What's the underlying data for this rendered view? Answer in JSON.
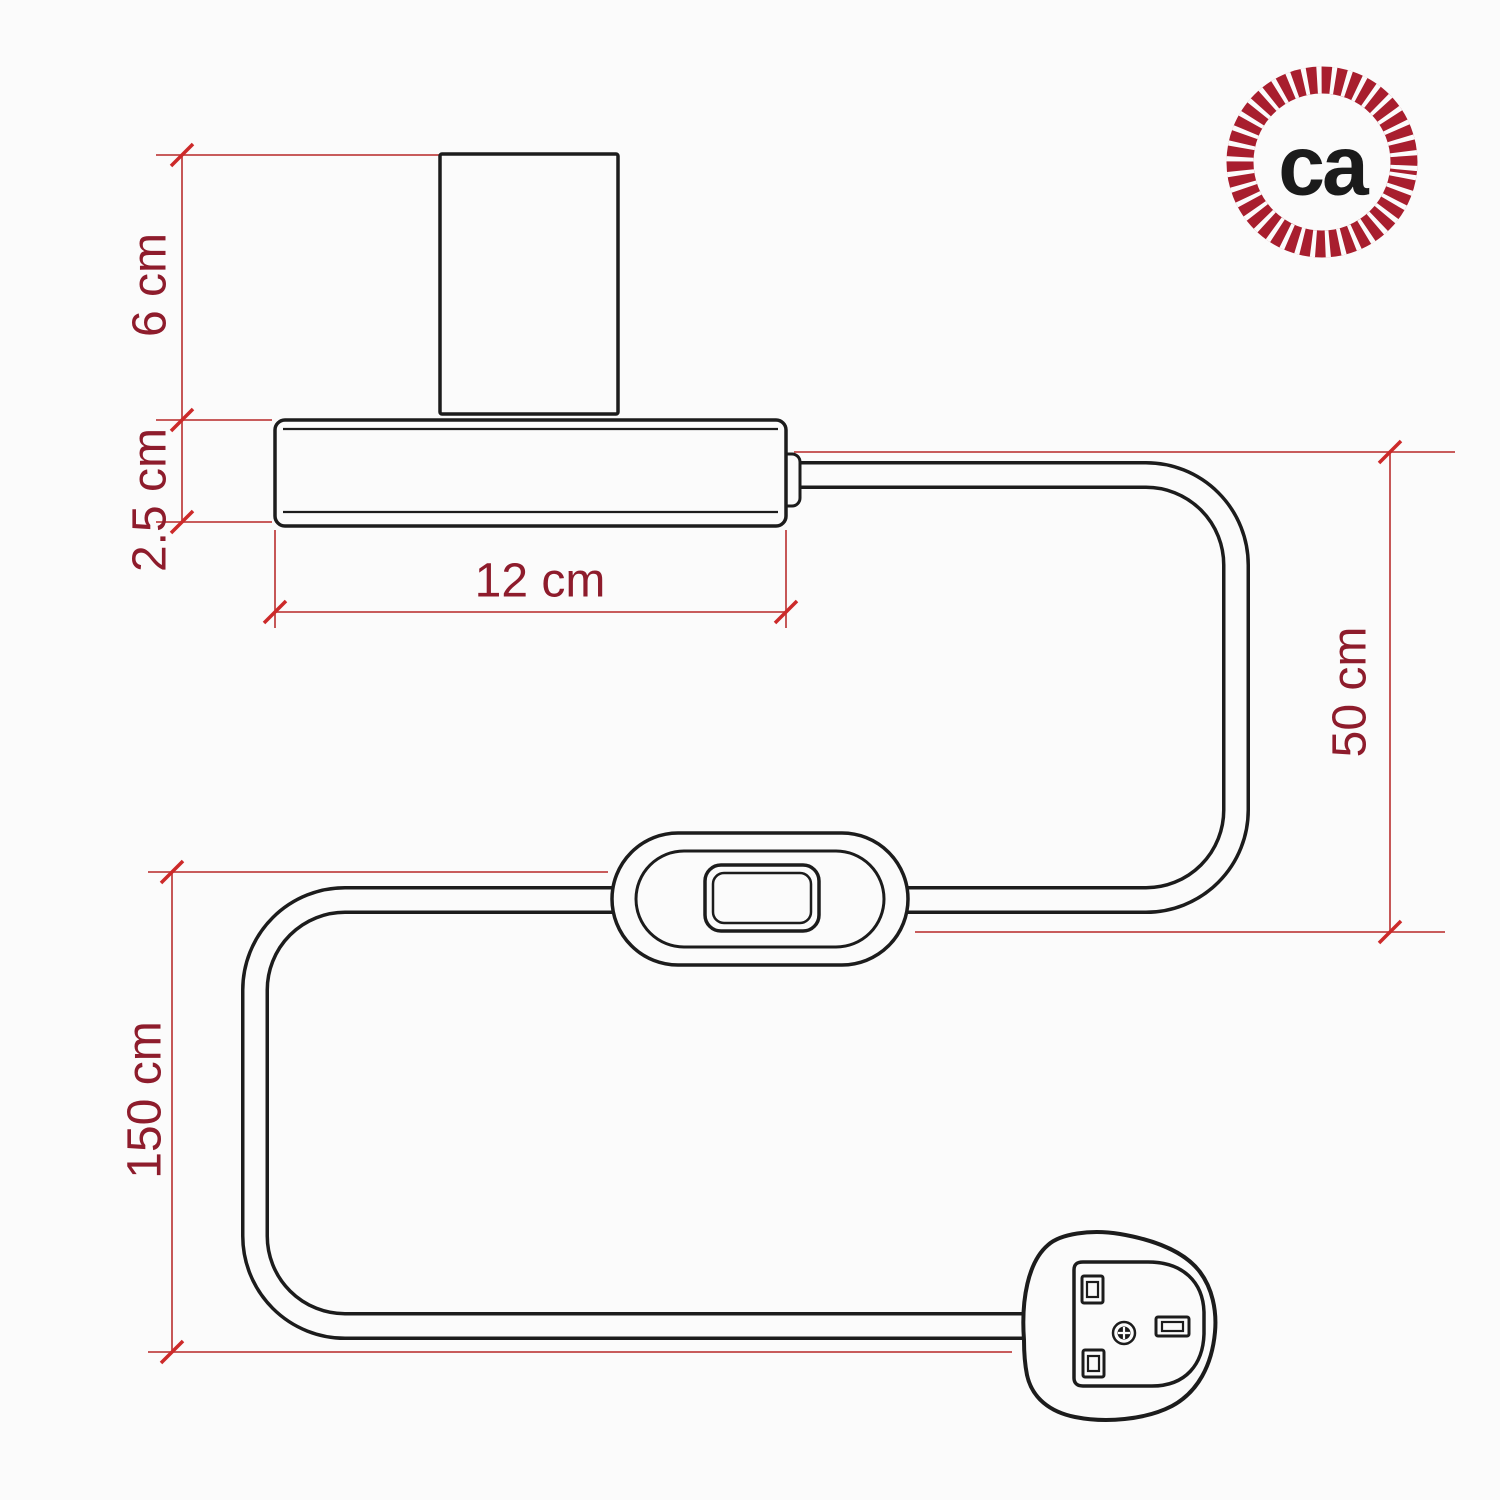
{
  "diagram": {
    "type": "product-dimension-drawing",
    "subject": "table lamp with inline switch and UK plug",
    "dims": {
      "d6": {
        "label": "6 cm"
      },
      "d25": {
        "label": "2.5 cm"
      },
      "d12": {
        "label": "12 cm"
      },
      "d50": {
        "label": "50 cm"
      },
      "d150": {
        "label": "150 cm"
      }
    }
  },
  "logo": {
    "text": "ca"
  },
  "colors": {
    "background": "#fbfbfb",
    "line_art": "#1c1c1c",
    "dimension_line": "#c04545",
    "tick": "#cc2a2a",
    "label_text": "#8e1c2c",
    "logo_ring": "#a81e2e",
    "logo_text": "#1b1b1b"
  }
}
